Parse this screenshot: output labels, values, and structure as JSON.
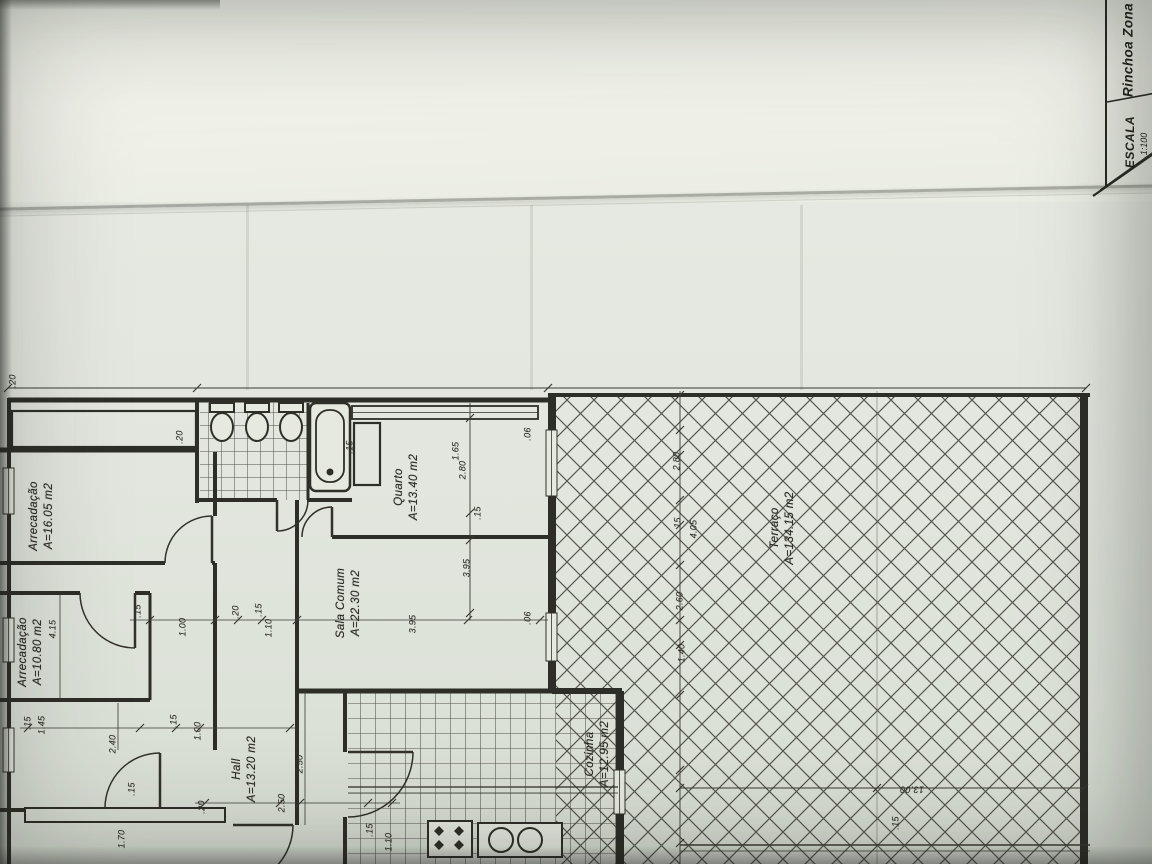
{
  "title_block": {
    "escala_label": "ESCALA",
    "escala_value": "1:100",
    "zone_label": "Rinchoa Zona"
  },
  "rooms": [
    {
      "name": "Arrecadação",
      "area": "A=16.05 m2"
    },
    {
      "name": "Arrecadação",
      "area": "A=10.80 m2"
    },
    {
      "name": "Quarto",
      "area": "A=13.40 m2"
    },
    {
      "name": "Sala Comum",
      "area": "A=22.30 m2"
    },
    {
      "name": "Hall",
      "area": "A=13.20 m2"
    },
    {
      "name": "Cozinha",
      "area": "A=12.95 m2"
    },
    {
      "name": "Terraço",
      "area": "A=134.15 m2"
    }
  ],
  "dimensions": [
    {
      "text": ".20",
      "x": 13,
      "y": 381
    },
    {
      "text": ".20",
      "x": 180,
      "y": 437
    },
    {
      "text": ".15",
      "x": 350,
      "y": 447
    },
    {
      "text": "1.65",
      "x": 456,
      "y": 451
    },
    {
      "text": "2.80",
      "x": 463,
      "y": 470
    },
    {
      "text": ".15",
      "x": 478,
      "y": 513
    },
    {
      "text": "3.95",
      "x": 467,
      "y": 568
    },
    {
      "text": ".06",
      "x": 528,
      "y": 434
    },
    {
      "text": ".06",
      "x": 528,
      "y": 618
    },
    {
      "text": "3.95",
      "x": 413,
      "y": 624
    },
    {
      "text": "4.15",
      "x": 53,
      "y": 629
    },
    {
      "text": ".15",
      "x": 28,
      "y": 723
    },
    {
      "text": "1.45",
      "x": 42,
      "y": 725
    },
    {
      "text": ".15",
      "x": 138,
      "y": 611
    },
    {
      "text": "1.00",
      "x": 183,
      "y": 627
    },
    {
      "text": ".20",
      "x": 236,
      "y": 612
    },
    {
      "text": ".15",
      "x": 259,
      "y": 610
    },
    {
      "text": "1.10",
      "x": 269,
      "y": 628
    },
    {
      "text": ".15",
      "x": 174,
      "y": 721
    },
    {
      "text": "1.00",
      "x": 198,
      "y": 731
    },
    {
      "text": "2.40",
      "x": 113,
      "y": 744
    },
    {
      "text": ".15",
      "x": 132,
      "y": 789
    },
    {
      "text": "1.70",
      "x": 122,
      "y": 839
    },
    {
      "text": ".20",
      "x": 202,
      "y": 807
    },
    {
      "text": "2.50",
      "x": 282,
      "y": 803
    },
    {
      "text": "2.50",
      "x": 300,
      "y": 764
    },
    {
      "text": ".15",
      "x": 370,
      "y": 830
    },
    {
      "text": "1.10",
      "x": 389,
      "y": 842
    },
    {
      "text": "2.80",
      "x": 677,
      "y": 461
    },
    {
      "text": ".15",
      "x": 678,
      "y": 524
    },
    {
      "text": "4.05",
      "x": 694,
      "y": 529
    },
    {
      "text": "2.60",
      "x": 680,
      "y": 601
    },
    {
      "text": "1.40",
      "x": 682,
      "y": 653
    },
    {
      "text": "13.00",
      "x": 912,
      "y": 789,
      "rot": 180
    },
    {
      "text": ".15",
      "x": 896,
      "y": 823
    }
  ]
}
